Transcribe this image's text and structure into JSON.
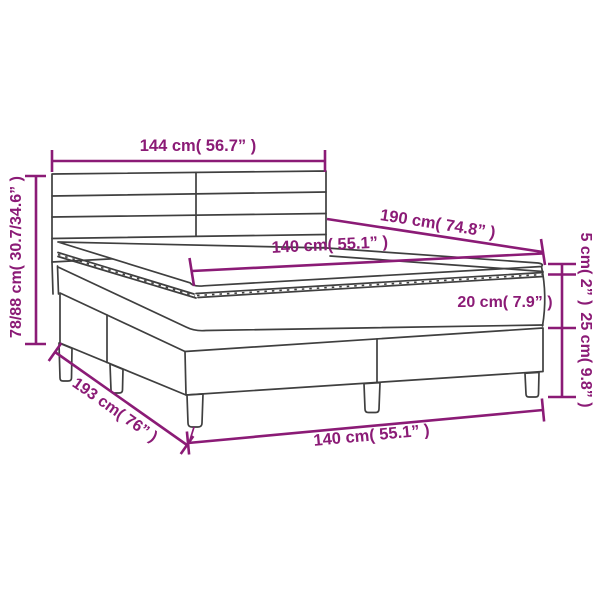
{
  "diagram": {
    "subject": "box-spring-bed-dimension-diagram",
    "colors": {
      "dimension": "#8B1B76",
      "outline": "#3F3F3F",
      "background": "#FFFFFF"
    },
    "labels": {
      "headboard_width": "144 cm( 56.7” )",
      "total_height": "78/88 cm( 30.7/34.6” )",
      "bed_length": "190 cm( 74.8” )",
      "mattress_width_top": "140 cm( 55.1” )",
      "pillow_top_height": "5 cm( 2” )",
      "mattress_height": "20 cm( 7.9” )",
      "base_height": "25 cm( 9.8” )",
      "base_length": "193 cm( 76” )",
      "base_width_bottom": "140 cm( 55.1” )"
    }
  }
}
